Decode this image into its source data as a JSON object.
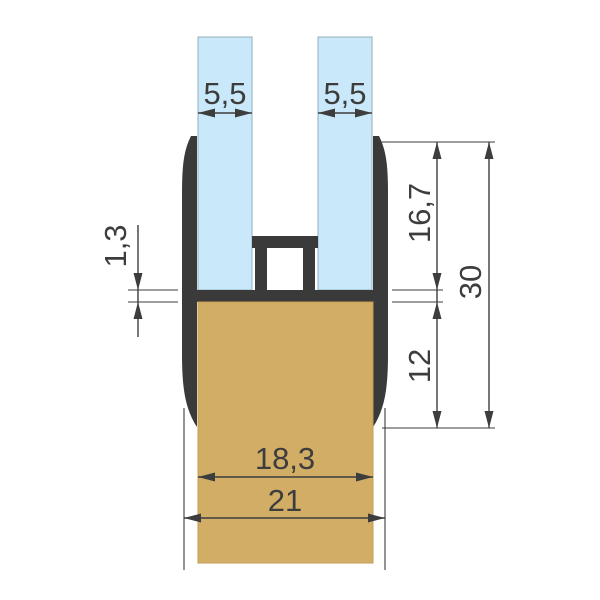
{
  "drawing": {
    "kind": "glass-clamp-profile-cross-section",
    "labels": {
      "glass_left_width": "5,5",
      "glass_right_width": "5,5",
      "lip_thickness": "1,3",
      "channel_depth": "16,7",
      "base_depth": "12",
      "profile_height": "30",
      "inner_width": "18,3",
      "outer_width": "21"
    },
    "colors": {
      "glass": "#c9e9fa",
      "glass_edge": "#93aebe",
      "profile": "#3a3a3a",
      "base": "#d1ad66",
      "base_edge": "#c59c57",
      "dim": "#3d3d3d",
      "background": "#ffffff"
    }
  }
}
